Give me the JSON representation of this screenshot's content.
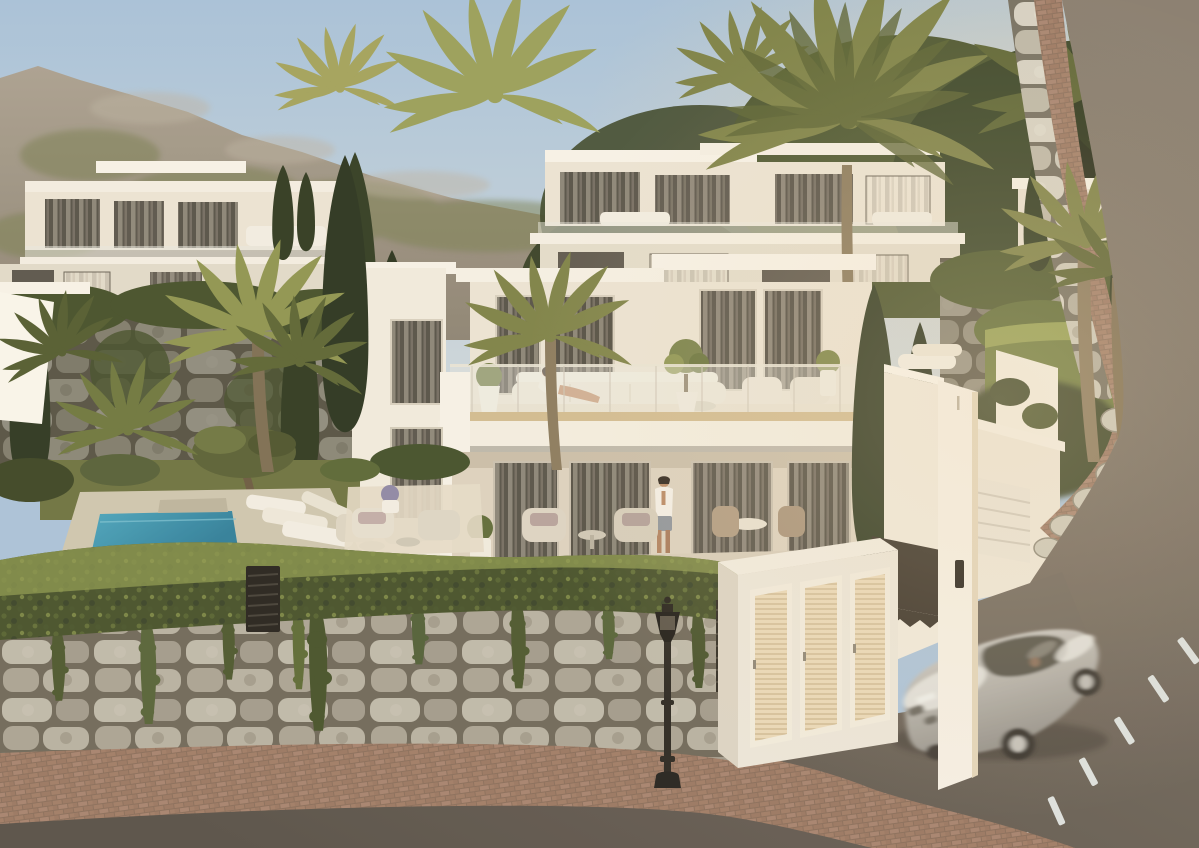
{
  "scene": {
    "type": "architectural-exterior-render",
    "time_of_day": "golden hour",
    "description": "Photorealistic golden-hour render of a modern hillside villa development: white cubic two-storey villas with glass-balustrade terraces, palms and cypresses, a turquoise plunge pool, ivy-draped stone retaining walls, a brick-paved sidewalk, a black street lamp, a white utility cabinet with three louvered doors, and a motion-blurred silver sports coupe on a curving asphalt road.",
    "colors": {
      "sky_top": "#a7c2dc",
      "sky_horizon": "#d6dde0",
      "warm_haze": "#f0d8b2",
      "mountain_light": "#aaa193",
      "mountain_dark": "#8d8476",
      "mountain_green": "#767d4f",
      "treeline_dark": "#3d472b",
      "tree_deep": "#262c1c",
      "villa_white": "#f6f1e8",
      "villa_cream": "#ece5d7",
      "villa_shadow": "#ddd3c2",
      "roof_slab": "#f8f4eb",
      "window_glass": "#56524a",
      "curtain_light": "#b6aea1",
      "balustrade_glass": "#e9e9e2",
      "terrace_floor": "#e8e0cf",
      "terrace_wood": "#d2bd93",
      "palm_sunlit": "#a3a35e",
      "palm_mid": "#7d8249",
      "palm_dark": "#5c6536",
      "cypress_dark": "#2f3a23",
      "trunk_brown": "#8a7a5f",
      "hedge_green": "#46512c",
      "hedge_highlight": "#8d9a52",
      "ivy_green": "#4c5830",
      "grass_green": "#6d7342",
      "pool_water": "#4aa6c0",
      "pool_deep": "#2f7f9d",
      "pool_deck": "#cfc7b2",
      "stone_light": "#d6d2c6",
      "stone_mid": "#b3aea1",
      "stone_joint": "#746f63",
      "brick_paving": "#a07d69",
      "brick_gap": "#8a6e5d",
      "asphalt_light": "#877d71",
      "asphalt_dark": "#57504a",
      "road_marking": "#dde2e2",
      "car_silver": "#d6d5d1",
      "car_shadow": "#94918c",
      "car_glass": "#55524c",
      "lamppost_black": "#2b2824",
      "louver_cream": "#ead9ba",
      "louver_line": "#c9b48e",
      "fence_dark": "#38322a",
      "skin_tone": "#b98a68",
      "white_fabric": "#f3efe6"
    },
    "buildings": {
      "main_villa": {
        "storeys": 2,
        "style": "modern white cubic, flat roof slabs",
        "features": [
          "glass balustrade terrace",
          "floor-to-ceiling curtained windows",
          "covered lower terrace",
          "potted olive trees"
        ]
      },
      "background_villas": {
        "count": 4,
        "style": "terraced white villas with balconies and outdoor lounges"
      },
      "garage": {
        "door": "white sectional door with horizontal grooves",
        "intercom": "black wall panel"
      }
    },
    "people": [
      {
        "label": "woman in white robe lounging on upper-terrace sofa"
      },
      {
        "label": "man in open white shirt and grey shorts on lower terrace"
      }
    ],
    "vehicle": {
      "label": "silver sports coupe, motion-blurred, driving downhill",
      "wheels_visible": 2
    },
    "street": {
      "road_marking_style": "white dashed centre line",
      "dash_count": 6,
      "sidewalk": "red-brown brick paving",
      "lamp": "black classic street lamp",
      "utility_cabinet_doors": 3
    },
    "pool": {
      "label": "turquoise plunge pool with travertine deck and white loungers"
    },
    "vegetation": [
      "canary palms",
      "italian cypresses",
      "ivy hedges",
      "hanging ivy over stone wall",
      "olive tree",
      "potted plants"
    ]
  }
}
